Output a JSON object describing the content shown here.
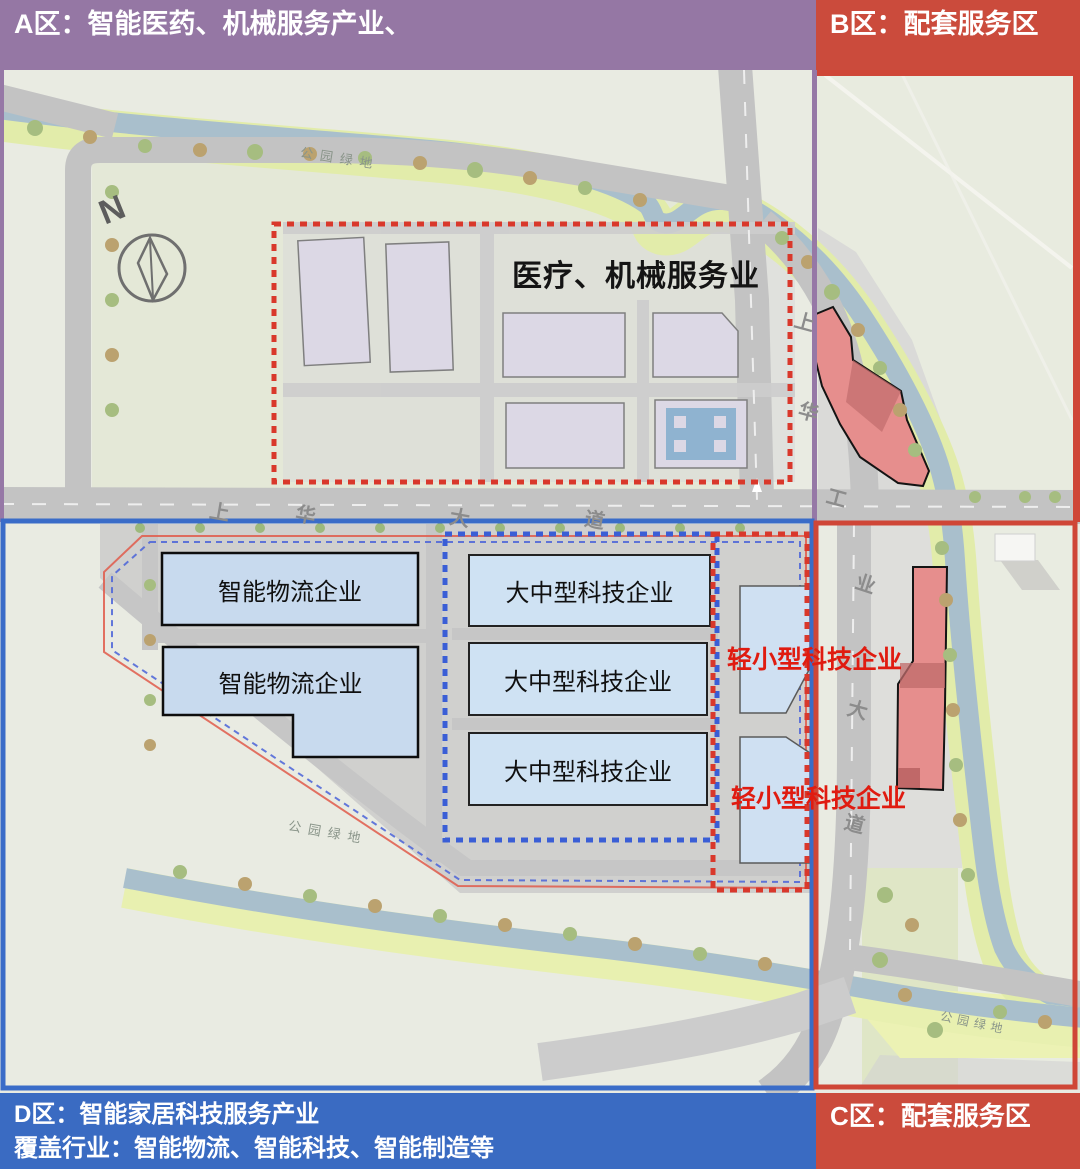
{
  "banners": {
    "a": "A区：智能医药、机械服务产业、",
    "b": "B区：配套服务区",
    "c": "C区：配套服务区",
    "d1": "D区：智能家居科技服务产业",
    "d2": "覆盖行业：智能物流、智能科技、智能制造等"
  },
  "labels": {
    "medical": "医疗、机械服务业",
    "logistics1": "智能物流企业",
    "logistics2": "智能物流企业",
    "tech_large1": "大中型科技企业",
    "tech_large2": "大中型科技企业",
    "tech_large3": "大中型科技企业",
    "tech_small1": "轻小型科技企业",
    "tech_small2": "轻小型科技企业",
    "compass": "N"
  },
  "roads": {
    "shanghua_avenue": [
      "上",
      "华",
      "大",
      "道"
    ],
    "shanghua_industrial_avenue": [
      "上",
      "华",
      "工",
      "业",
      "大",
      "道"
    ]
  },
  "green_areas": [
    "公园绿地",
    "公园绿地",
    "公园绿地"
  ],
  "colors": {
    "zone_a_purple": "#9577a4",
    "zone_bc_red": "#cb4b3c",
    "zone_d_blue": "#3a6bc2",
    "dotted_red": "#d9382b",
    "dotted_blue": "#3a5ed6",
    "highlight_red_text": "#e01b10",
    "box_blue_fill": "#cfe2f3",
    "building_red_fill": "#e68e8d",
    "river": "#a9bfcc"
  }
}
